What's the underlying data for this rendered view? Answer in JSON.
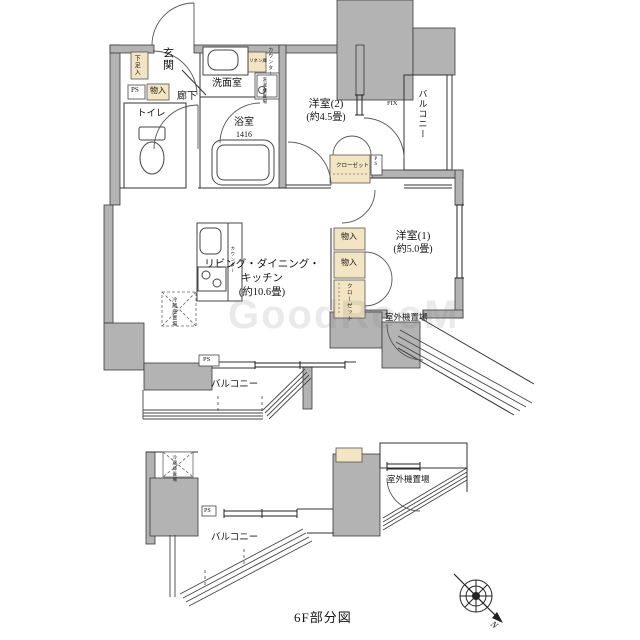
{
  "caption": "6F部分図",
  "compass": {
    "north_label": "N"
  },
  "watermark": "GoodRooM",
  "main_plan": {
    "entrance": {
      "genkan": "玄関",
      "shoe_box": "下足入",
      "ps": "PS",
      "storage": "物入",
      "hallway": "廊下",
      "toilet": "トイレ"
    },
    "wash": {
      "washroom": "洗面室",
      "linen": "リネン庫",
      "counter": "カウンター",
      "laundry": "洗濯機置場"
    },
    "bath": {
      "name": "浴室",
      "size": "1416"
    },
    "bedroom2": {
      "name": "洋室(2)",
      "size": "(約4.5畳)",
      "closet": "クローゼット",
      "fix_window": "FIX",
      "balcony": "バルコニー",
      "ps": "PS"
    },
    "bedroom1": {
      "name": "洋室(1)",
      "size": "(約5.0畳)",
      "storage1": "物入",
      "storage2": "物入",
      "closet": "クローゼット"
    },
    "ldk": {
      "line1": "リビング・ダイニング・",
      "line2": "キッチン",
      "line3": "(約10.6畳)",
      "counter": "カウンター",
      "refrigerator": "冷蔵庫置場",
      "ps": "PS"
    },
    "south": {
      "balcony": "バルコニー",
      "outdoor_unit": "室外機置場"
    }
  },
  "lower_plan": {
    "refrigerator": "冷蔵庫置場",
    "ps": "PS",
    "balcony": "バルコニー",
    "outdoor_unit": "室外機置場"
  }
}
